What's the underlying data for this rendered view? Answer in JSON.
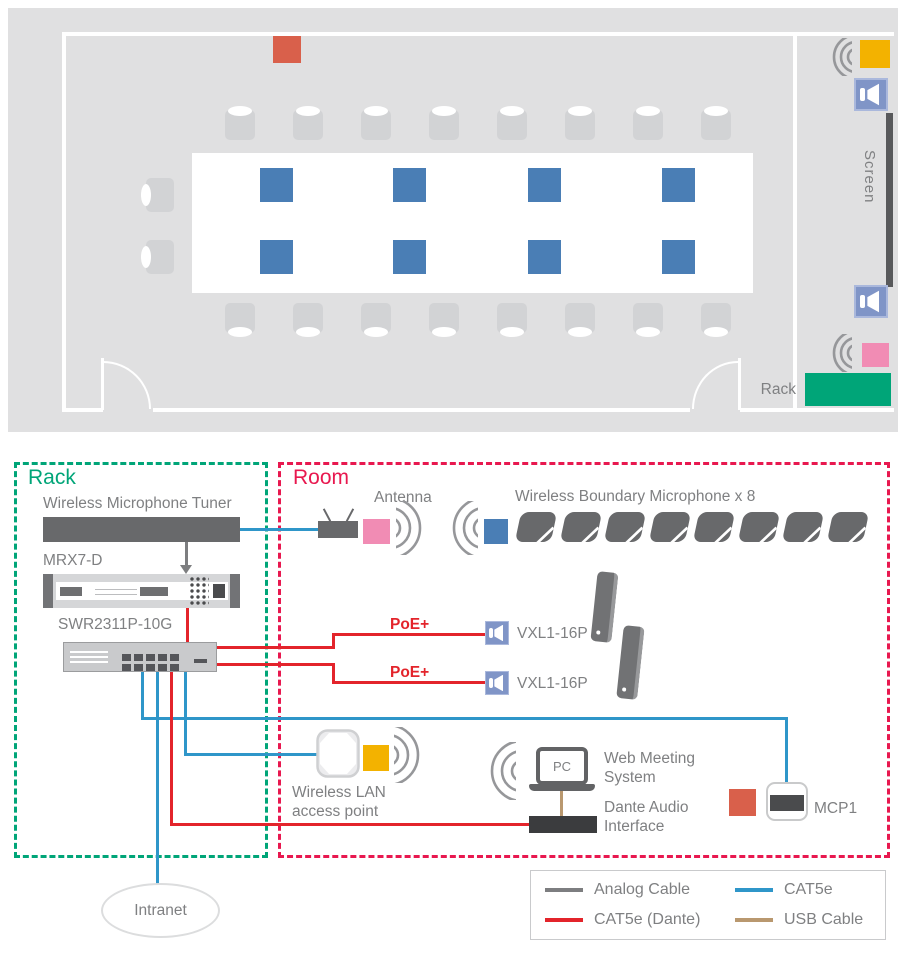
{
  "floor_plan": {
    "screen_label": "Screen",
    "rack_label": "Rack"
  },
  "rack_section": {
    "title": "Rack",
    "devices": {
      "tuner": "Wireless Microphone Tuner",
      "processor": "MRX7-D",
      "switch": "SWR2311P-10G"
    }
  },
  "room_section": {
    "title": "Room",
    "antenna_label": "Antenna",
    "boundary_mic_label": "Wireless Boundary Microphone x 8",
    "poe_label_1": "PoE+",
    "poe_label_2": "PoE+",
    "speaker_1": "VXL1-16P",
    "speaker_2": "VXL1-16P",
    "wlan_line1": "Wireless LAN",
    "wlan_line2": "access point",
    "pc_label": "PC",
    "web_meeting_line1": "Web Meeting",
    "web_meeting_line2": "System",
    "dante_line1": "Dante Audio",
    "dante_line2": "Interface",
    "mcp_label": "MCP1"
  },
  "network": {
    "intranet_label": "Intranet"
  },
  "legend": {
    "items": [
      {
        "label": "Analog Cable",
        "color": "#7d7e80"
      },
      {
        "label": "CAT5e (Dante)",
        "color": "#e3242b"
      },
      {
        "label": "CAT5e",
        "color": "#2f96c9"
      },
      {
        "label": "USB Cable",
        "color": "#b9986f"
      }
    ]
  },
  "colors": {
    "boundary_mic_blue": "#4a7eb5",
    "mcp_orange": "#d9604b",
    "wlan_yellow": "#f3b200",
    "antenna_pink": "#f18cb4",
    "rack_green": "#00a578",
    "room_box_red": "#e8184f",
    "plan_background": "#e0e0e1"
  }
}
